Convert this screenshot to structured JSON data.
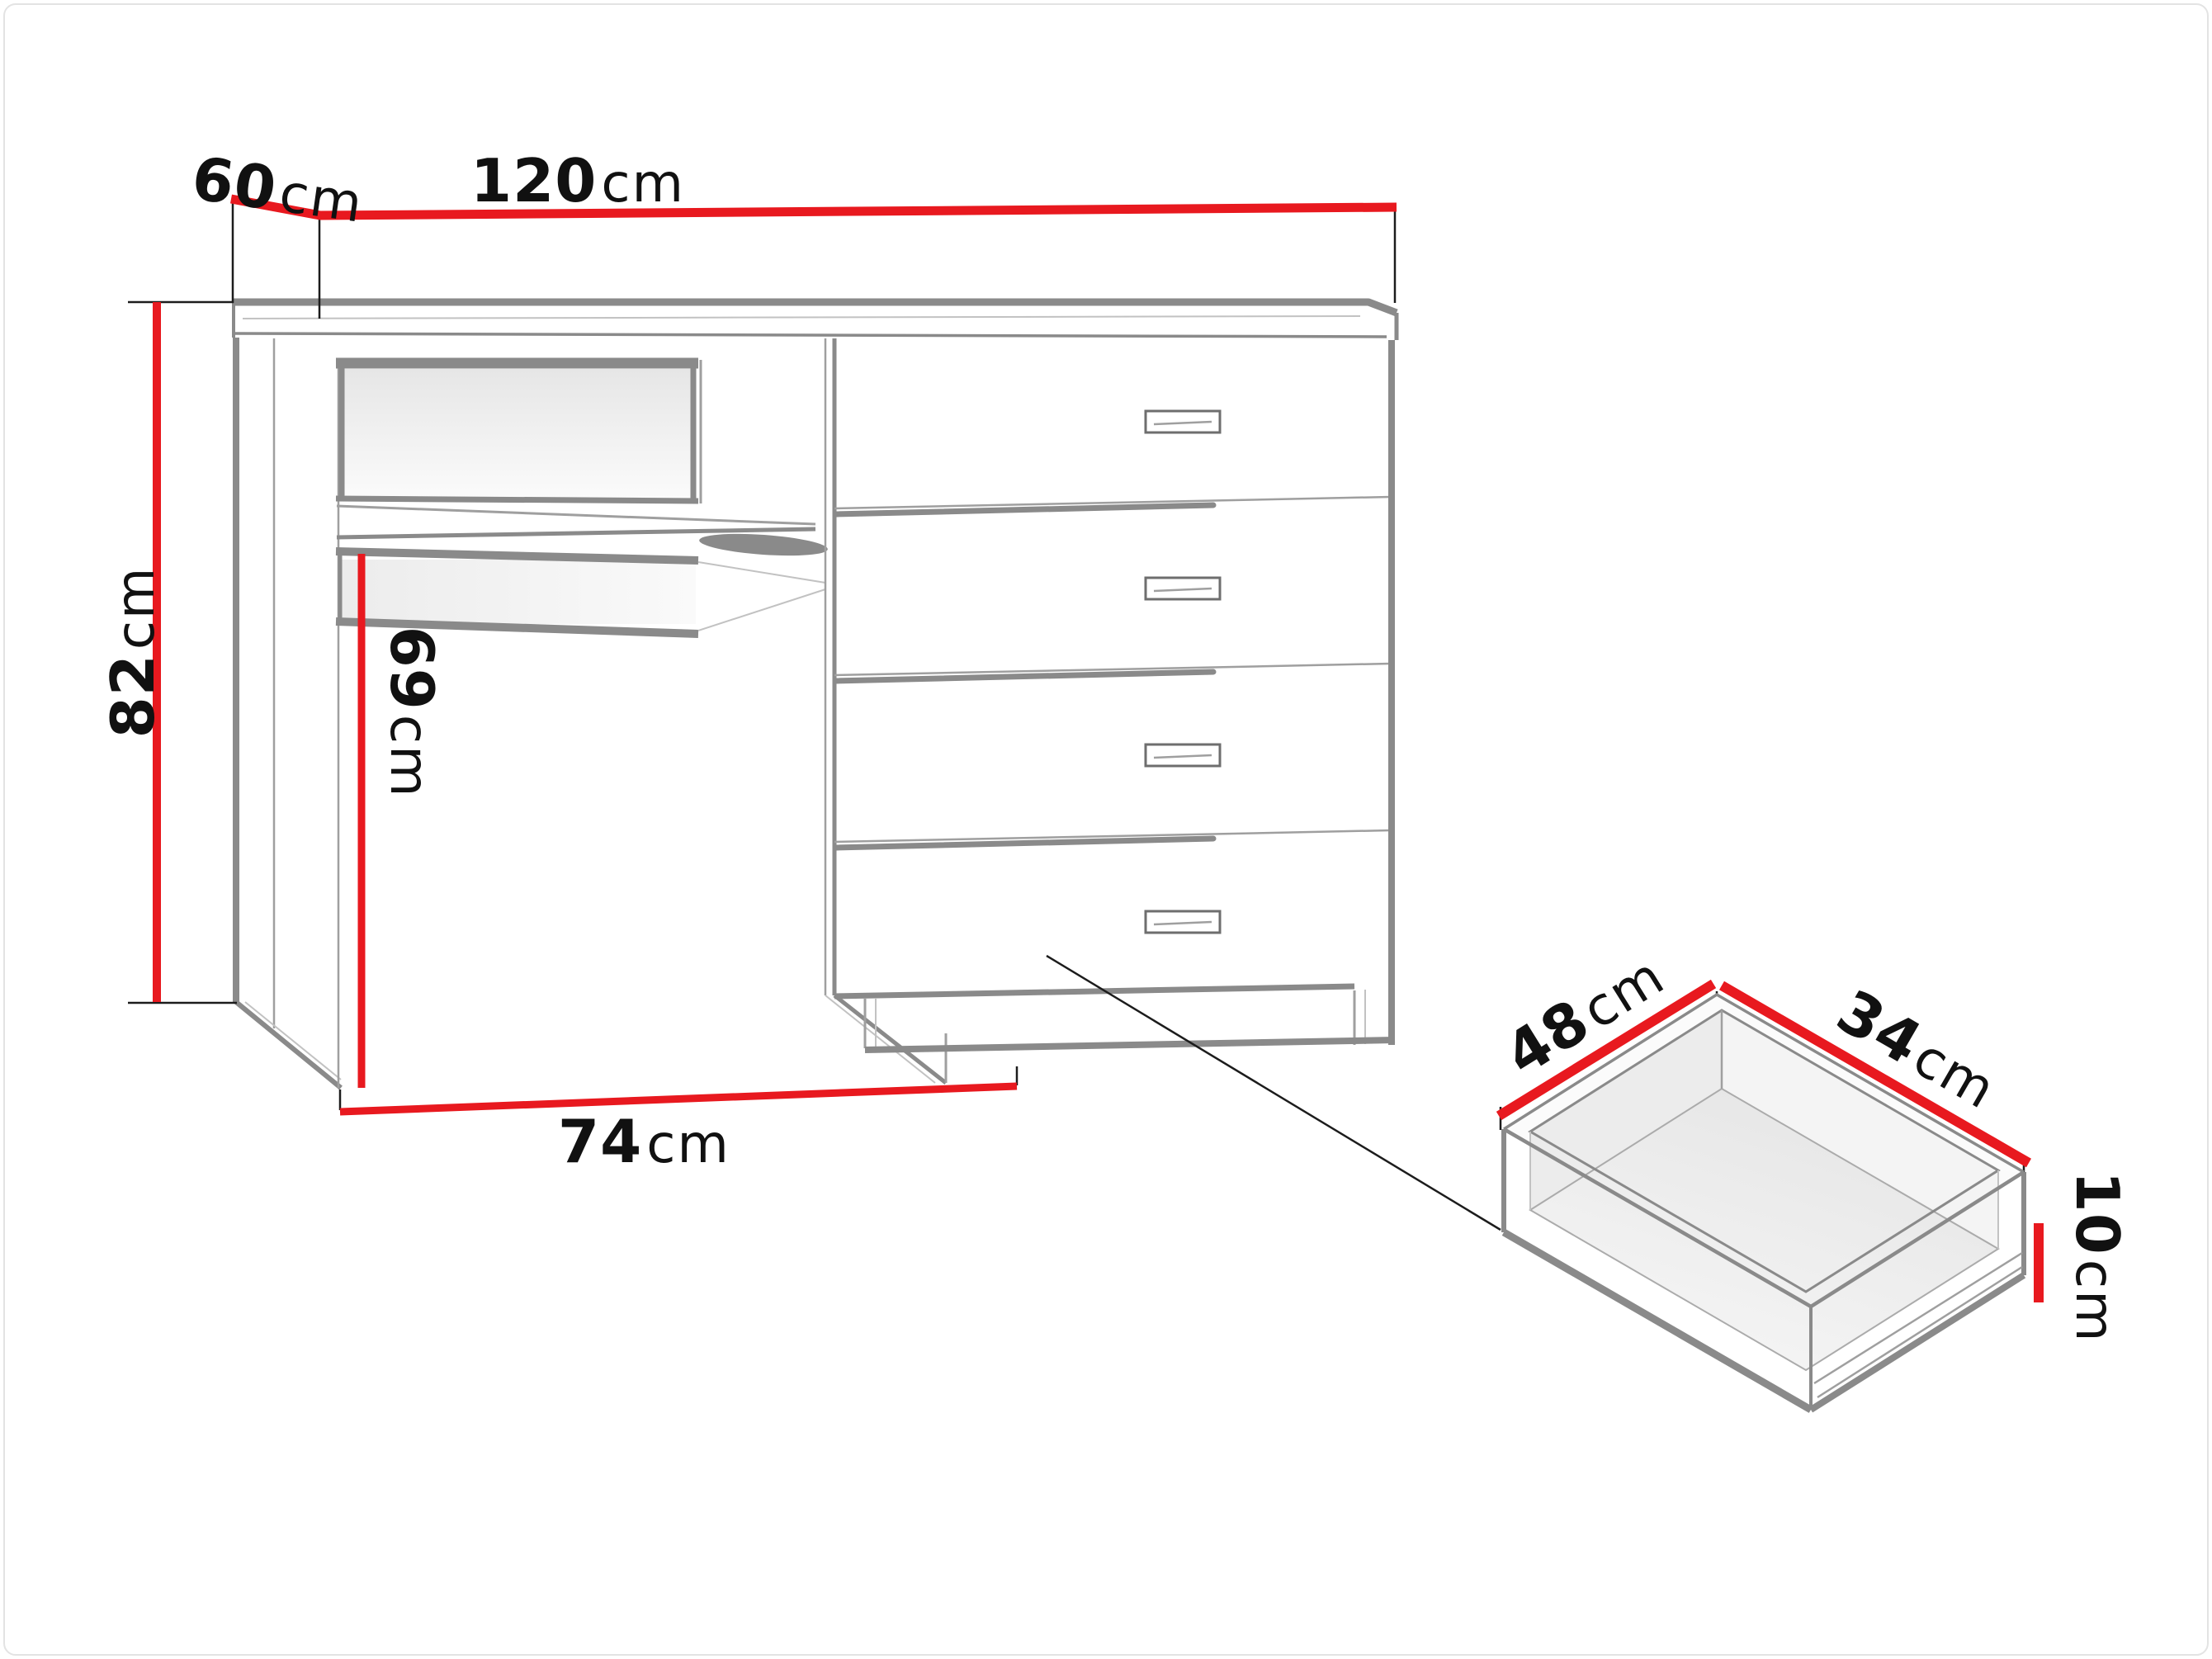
{
  "desk": {
    "width": {
      "value": "120",
      "unit": "cm"
    },
    "depth": {
      "value": "60",
      "unit": "cm"
    },
    "height": {
      "value": "82",
      "unit": "cm"
    },
    "underdesk_height": {
      "value": "69",
      "unit": "cm"
    },
    "underdesk_width": {
      "value": "74",
      "unit": "cm"
    }
  },
  "drawer": {
    "depth": {
      "value": "48",
      "unit": "cm"
    },
    "width": {
      "value": "34",
      "unit": "cm"
    },
    "height": {
      "value": "10",
      "unit": "cm"
    }
  },
  "colors": {
    "dimension_red": "#e8191f",
    "sketch_gray": "#8a8a8a",
    "extension_black": "#1c1c1c",
    "text_black": "#111111"
  }
}
